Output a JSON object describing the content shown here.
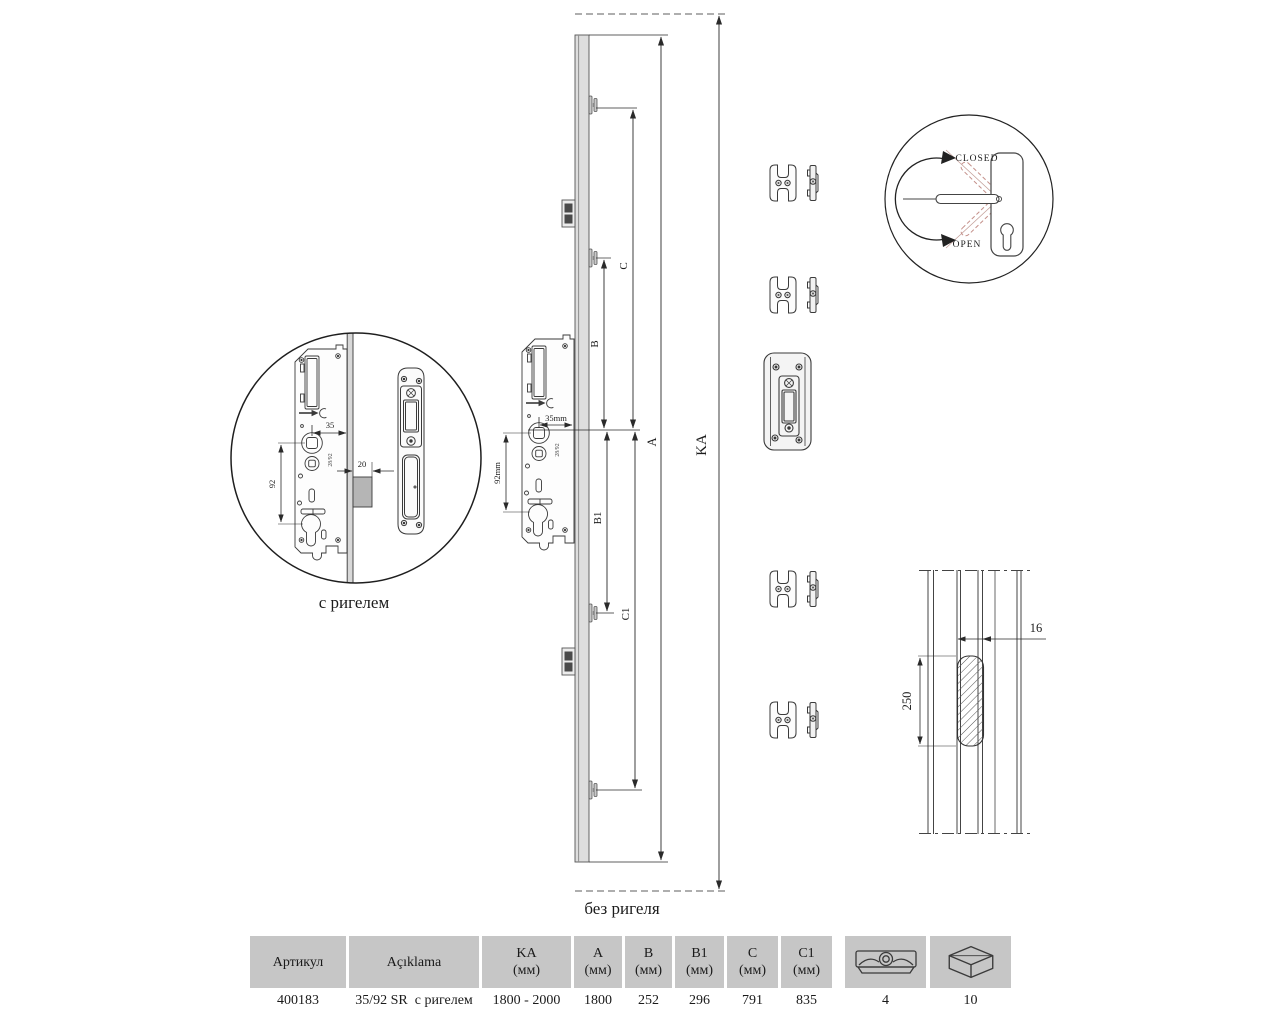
{
  "diagram": {
    "labels": {
      "with_bolt": "с ригелем",
      "without_bolt": "без ригеля"
    },
    "dims": {
      "A": "A",
      "B": "B",
      "B1": "B1",
      "C": "C",
      "C1": "C1",
      "KA": "KA"
    },
    "lock_case": {
      "backset": "35mm",
      "pz": "92mm",
      "stamp": "28/92"
    },
    "detail_case": {
      "backset": "35",
      "pz": "92",
      "bolt_throw": "20",
      "stamp": "28/92"
    },
    "handle": {
      "closed": "CLOSED",
      "open": "OPEN"
    },
    "profile": {
      "groove_width": "16",
      "slot_height": "250"
    }
  },
  "table": {
    "headers": [
      {
        "label": "Артикул",
        "sub": ""
      },
      {
        "label": "Açıklama",
        "sub": ""
      },
      {
        "label": "KA",
        "sub": "(мм)"
      },
      {
        "label": "A",
        "sub": "(мм)"
      },
      {
        "label": "B",
        "sub": "(мм)"
      },
      {
        "label": "B1",
        "sub": "(мм)"
      },
      {
        "label": "C",
        "sub": "(мм)"
      },
      {
        "label": "C1",
        "sub": "(мм)"
      }
    ],
    "icon_columns": [
      "roller-cam-icon",
      "package-icon"
    ],
    "row": [
      "400183",
      "35/92 SR  с ригелем",
      "1800 - 2000",
      "1800",
      "252",
      "296",
      "791",
      "835",
      "4",
      "10"
    ]
  }
}
